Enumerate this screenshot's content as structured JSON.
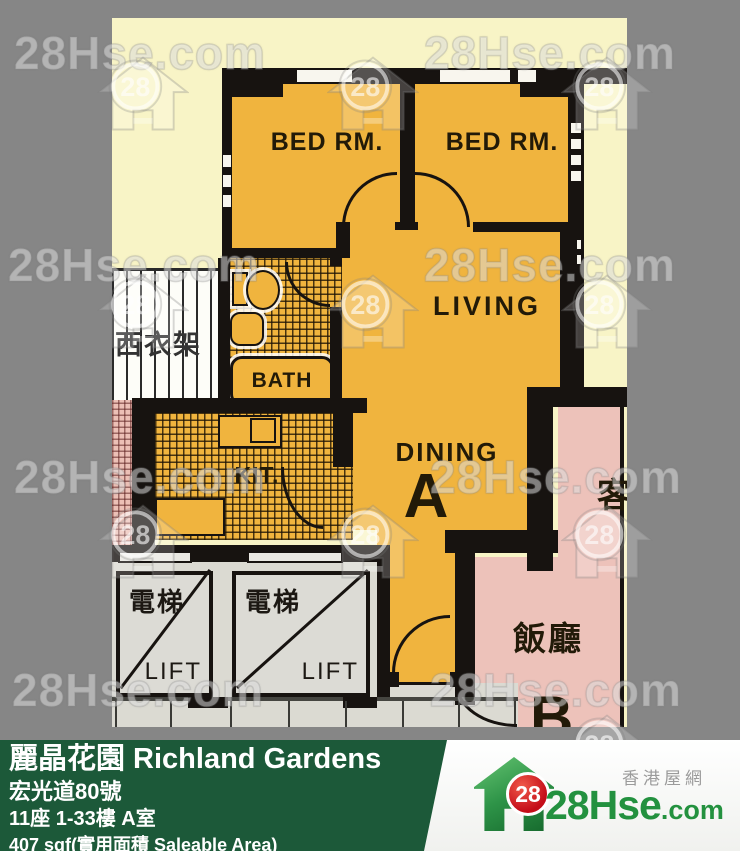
{
  "watermark": {
    "text": "28Hse.com",
    "logo_number": "28"
  },
  "plan": {
    "rooms": {
      "bedroom_left": "BED RM.",
      "bedroom_right": "BED RM.",
      "living": "LIVING",
      "dining": "DINING",
      "unit_a": "A",
      "kitchen": "KIT.",
      "bath": "BATH",
      "drying_rack": "西衣架",
      "neighbor_living": "客",
      "neighbor_dining": "飯廳",
      "unit_b": "B"
    },
    "lifts": [
      {
        "cn": "電梯",
        "en": "LIFT"
      },
      {
        "cn": "電梯",
        "en": "LIFT"
      }
    ]
  },
  "infobar": {
    "title": "麗晶花園 Richland Gardens",
    "address": "宏光道80號",
    "block_floor_flat": "11座 1-33樓 A室",
    "area": "407 sqf(實用面積 Saleable Area)"
  },
  "footer": {
    "site_cn": "香港屋網",
    "brand_main": "28Hse",
    "brand_suffix": ".com",
    "badge": "28"
  },
  "colors": {
    "background_gray": "#868686",
    "plan_paper": "#f8f4c6",
    "unit_orange": "#f0b43e",
    "neighbor_pink": "#edc2ba",
    "lobby_gray": "#dbdad2",
    "bar_green": "#1c5939",
    "brand_green": "#23913f",
    "badge_red": "#c40d18"
  }
}
